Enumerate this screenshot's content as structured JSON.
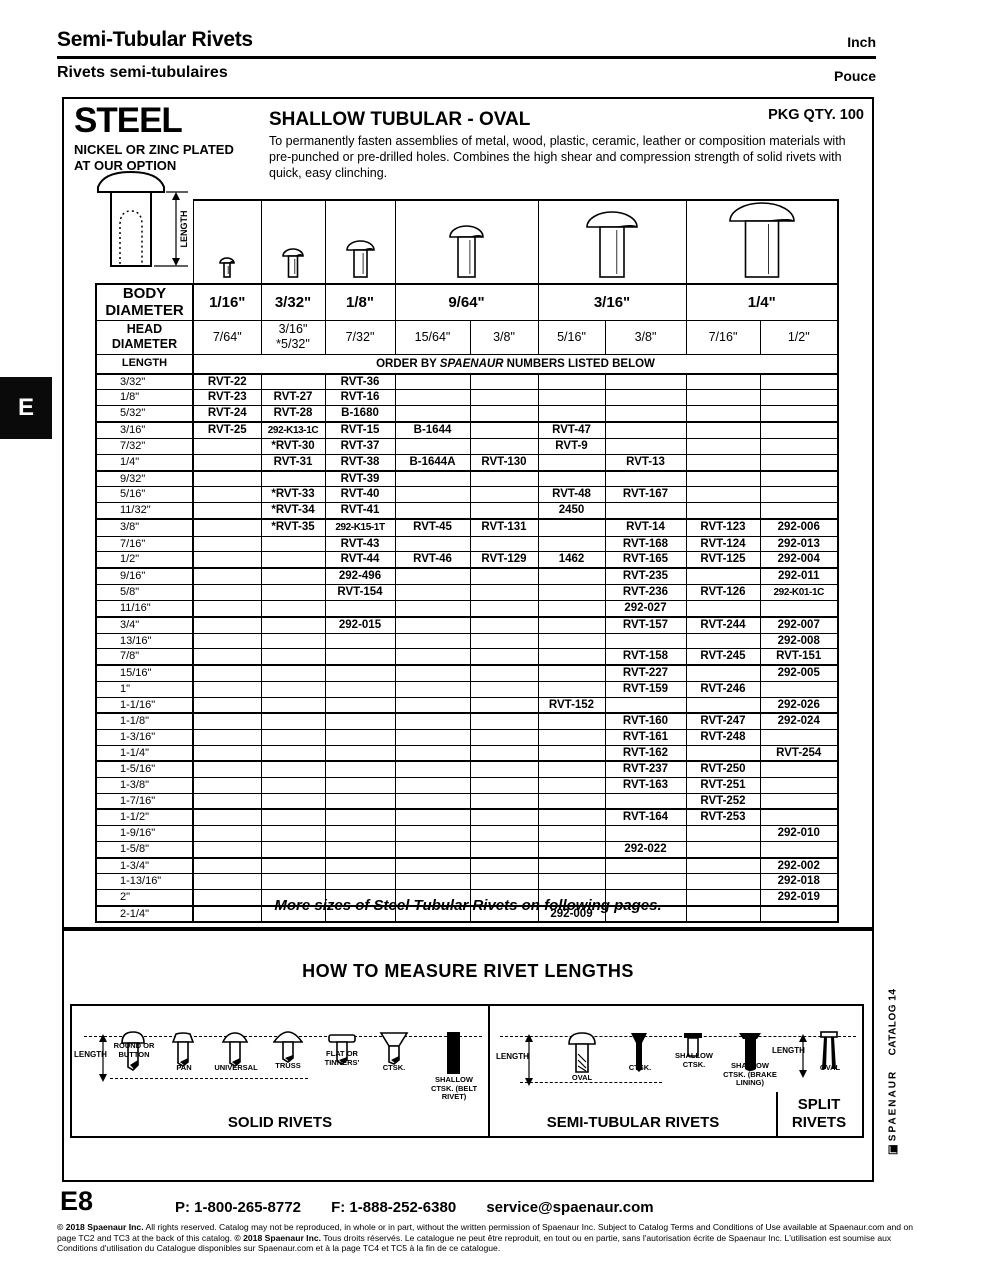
{
  "page": {
    "header": {
      "title_en": "Semi-Tubular Rivets",
      "unit_en": "Inch",
      "title_fr": "Rivets semi-tubulaires",
      "unit_fr": "Pouce"
    },
    "section_tab": "E",
    "side": {
      "catalog": "CATALOG 14",
      "brand": "SPAENAUR"
    },
    "footer": {
      "page_number": "E8",
      "phone": "P: 1-800-265-8772",
      "fax": "F: 1-888-252-6380",
      "email": "service@spaenaur.com",
      "legal_c1": "© 2018 Spaenaur Inc.",
      "legal_t1": " All rights reserved. Catalog may not be reproduced, in whole or in part, without the written permission of Spaenaur Inc. Subject to Catalog Terms and Conditions of Use available at Spaenaur.com and on page TC2 and TC3 at the back of this catalog. ",
      "legal_c2": "© 2018 Spaenaur Inc.",
      "legal_t2": " Tous droits réservés. Le catalogue ne peut être reproduit, en tout ou en partie, sans l'autorisation écrite de Spaenaur Inc. L'utilisation est soumise aux Conditions d'utilisation du Catalogue disponibles sur Spaenaur.com et à la page TC4 et TC5 à la fin de ce catalogue."
    }
  },
  "product": {
    "material": "STEEL",
    "plating_line1": "NICKEL OR ZINC PLATED",
    "plating_line2": "AT OUR OPTION",
    "style": "SHALLOW TUBULAR - OVAL",
    "pkg_qty": "PKG QTY. 100",
    "description": "To permanently fasten assemblies of metal, wood, plastic, ceramic, leather or composition materials with pre-punched or pre-drilled holes.  Combines the high shear and compression strength of solid rivets with quick, easy clinching.",
    "length_dim_label": "LENGTH"
  },
  "table": {
    "body_diameter_label": "BODY\nDIAMETER",
    "head_diameter_label": "HEAD\nDIAMETER",
    "length_label": "LENGTH",
    "order_note_prefix": "ORDER BY ",
    "order_note_brand": "SPAENAUR",
    "order_note_suffix": "  NUMBERS LISTED BELOW",
    "body_diameters": [
      {
        "label": "1/16\"",
        "span": 1
      },
      {
        "label": "3/32\"",
        "span": 1
      },
      {
        "label": "1/8\"",
        "span": 1
      },
      {
        "label": "9/64\"",
        "span": 2
      },
      {
        "label": "3/16\"",
        "span": 2
      },
      {
        "label": "1/4\"",
        "span": 2
      }
    ],
    "head_diameters": [
      "7/64\"",
      "3/16\"\n*5/32\"",
      "7/32\"",
      "15/64\"",
      "3/8\"",
      "5/16\"",
      "3/8\"",
      "7/16\"",
      "1/2\""
    ],
    "rows": [
      {
        "length": "3/32\"",
        "cells": [
          "RVT-22",
          "",
          "RVT-36",
          "",
          "",
          "",
          "",
          "",
          ""
        ]
      },
      {
        "length": "1/8\"",
        "cells": [
          "RVT-23",
          "RVT-27",
          "RVT-16",
          "",
          "",
          "",
          "",
          "",
          ""
        ]
      },
      {
        "length": "5/32\"",
        "cells": [
          "RVT-24",
          "RVT-28",
          "B-1680",
          "",
          "",
          "",
          "",
          "",
          ""
        ]
      },
      {
        "length": "3/16\"",
        "cells": [
          "RVT-25",
          "292-K13-1C",
          "RVT-15",
          "B-1644",
          "",
          "RVT-47",
          "",
          "",
          ""
        ]
      },
      {
        "length": "7/32\"",
        "cells": [
          "",
          "*RVT-30",
          "RVT-37",
          "",
          "",
          "RVT-9",
          "",
          "",
          ""
        ]
      },
      {
        "length": "1/4\"",
        "cells": [
          "",
          "RVT-31",
          "RVT-38",
          "B-1644A",
          "RVT-130",
          "",
          "RVT-13",
          "",
          ""
        ]
      },
      {
        "length": "9/32\"",
        "cells": [
          "",
          "",
          "RVT-39",
          "",
          "",
          "",
          "",
          "",
          ""
        ]
      },
      {
        "length": "5/16\"",
        "cells": [
          "",
          "*RVT-33",
          "RVT-40",
          "",
          "",
          "RVT-48",
          "RVT-167",
          "",
          ""
        ]
      },
      {
        "length": "11/32\"",
        "cells": [
          "",
          "*RVT-34",
          "RVT-41",
          "",
          "",
          "2450",
          "",
          "",
          ""
        ]
      },
      {
        "length": "3/8\"",
        "cells": [
          "",
          "*RVT-35",
          "292-K15-1T",
          "RVT-45",
          "RVT-131",
          "",
          "RVT-14",
          "RVT-123",
          "292-006"
        ]
      },
      {
        "length": "7/16\"",
        "cells": [
          "",
          "",
          "RVT-43",
          "",
          "",
          "",
          "RVT-168",
          "RVT-124",
          "292-013"
        ]
      },
      {
        "length": "1/2\"",
        "cells": [
          "",
          "",
          "RVT-44",
          "RVT-46",
          "RVT-129",
          "1462",
          "RVT-165",
          "RVT-125",
          "292-004"
        ]
      },
      {
        "length": "9/16\"",
        "cells": [
          "",
          "",
          "292-496",
          "",
          "",
          "",
          "RVT-235",
          "",
          "292-011"
        ]
      },
      {
        "length": "5/8\"",
        "cells": [
          "",
          "",
          "RVT-154",
          "",
          "",
          "",
          "RVT-236",
          "RVT-126",
          "292-K01-1C"
        ]
      },
      {
        "length": "11/16\"",
        "cells": [
          "",
          "",
          "",
          "",
          "",
          "",
          "292-027",
          "",
          ""
        ]
      },
      {
        "length": "3/4\"",
        "cells": [
          "",
          "",
          "292-015",
          "",
          "",
          "",
          "RVT-157",
          "RVT-244",
          "292-007"
        ]
      },
      {
        "length": "13/16\"",
        "cells": [
          "",
          "",
          "",
          "",
          "",
          "",
          "",
          "",
          "292-008"
        ]
      },
      {
        "length": "7/8\"",
        "cells": [
          "",
          "",
          "",
          "",
          "",
          "",
          "RVT-158",
          "RVT-245",
          "RVT-151"
        ]
      },
      {
        "length": "15/16\"",
        "cells": [
          "",
          "",
          "",
          "",
          "",
          "",
          "RVT-227",
          "",
          "292-005"
        ]
      },
      {
        "length": "1\"",
        "cells": [
          "",
          "",
          "",
          "",
          "",
          "",
          "RVT-159",
          "RVT-246",
          ""
        ]
      },
      {
        "length": "1-1/16\"",
        "cells": [
          "",
          "",
          "",
          "",
          "",
          "RVT-152",
          "",
          "",
          "292-026"
        ]
      },
      {
        "length": "1-1/8\"",
        "cells": [
          "",
          "",
          "",
          "",
          "",
          "",
          "RVT-160",
          "RVT-247",
          "292-024"
        ]
      },
      {
        "length": "1-3/16\"",
        "cells": [
          "",
          "",
          "",
          "",
          "",
          "",
          "RVT-161",
          "RVT-248",
          ""
        ]
      },
      {
        "length": "1-1/4\"",
        "cells": [
          "",
          "",
          "",
          "",
          "",
          "",
          "RVT-162",
          "",
          "RVT-254"
        ]
      },
      {
        "length": "1-5/16\"",
        "cells": [
          "",
          "",
          "",
          "",
          "",
          "",
          "RVT-237",
          "RVT-250",
          ""
        ]
      },
      {
        "length": "1-3/8\"",
        "cells": [
          "",
          "",
          "",
          "",
          "",
          "",
          "RVT-163",
          "RVT-251",
          ""
        ]
      },
      {
        "length": "1-7/16\"",
        "cells": [
          "",
          "",
          "",
          "",
          "",
          "",
          "",
          "RVT-252",
          ""
        ]
      },
      {
        "length": "1-1/2\"",
        "cells": [
          "",
          "",
          "",
          "",
          "",
          "",
          "RVT-164",
          "RVT-253",
          ""
        ]
      },
      {
        "length": "1-9/16\"",
        "cells": [
          "",
          "",
          "",
          "",
          "",
          "",
          "",
          "",
          "292-010"
        ]
      },
      {
        "length": "1-5/8\"",
        "cells": [
          "",
          "",
          "",
          "",
          "",
          "",
          "292-022",
          "",
          ""
        ]
      },
      {
        "length": "1-3/4\"",
        "cells": [
          "",
          "",
          "",
          "",
          "",
          "",
          "",
          "",
          "292-002"
        ]
      },
      {
        "length": "1-13/16\"",
        "cells": [
          "",
          "",
          "",
          "",
          "",
          "",
          "",
          "",
          "292-018"
        ]
      },
      {
        "length": "2\"",
        "cells": [
          "",
          "",
          "",
          "",
          "",
          "",
          "",
          "",
          "292-019"
        ]
      },
      {
        "length": "2-1/4\"",
        "cells": [
          "",
          "",
          "",
          "",
          "",
          "292-009",
          "",
          "",
          ""
        ]
      }
    ]
  },
  "note": "More sizes of Steel Tubular Rivets on following pages.",
  "measure": {
    "title": "HOW TO MEASURE RIVET LENGTHS",
    "solid": {
      "caption": "SOLID RIVETS",
      "length_label": "LENGTH",
      "items": [
        {
          "label": "ROUND OR BUTTON",
          "glyph": "round-rivet"
        },
        {
          "label": "PAN",
          "glyph": "pan-rivet"
        },
        {
          "label": "UNIVERSAL",
          "glyph": "universal-rivet"
        },
        {
          "label": "TRUSS",
          "glyph": "truss-rivet"
        },
        {
          "label": "FLAT OR TINNERS'",
          "glyph": "flat-rivet"
        },
        {
          "label": "CTSK.",
          "glyph": "ctsk-rivet"
        },
        {
          "label": "SHALLOW CTSK. (BELT RIVET)",
          "glyph": "belt-rivet"
        }
      ]
    },
    "semi": {
      "caption": "SEMI-TUBULAR RIVETS",
      "length_label": "LENGTH",
      "items": [
        {
          "label": "OVAL",
          "glyph": "oval-tubular-rivet"
        },
        {
          "label": "CTSK.",
          "glyph": "ctsk-tubular-rivet"
        },
        {
          "label": "SHALLOW CTSK.",
          "glyph": "shallow-ctsk-rivet"
        },
        {
          "label": "SHALLOW CTSK. (BRAKE LINING)",
          "glyph": "brake-lining-rivet"
        }
      ]
    },
    "split": {
      "caption": "SPLIT RIVETS",
      "length_label": "LENGTH",
      "items": [
        {
          "label": "OVAL",
          "glyph": "split-rivet"
        }
      ]
    }
  }
}
